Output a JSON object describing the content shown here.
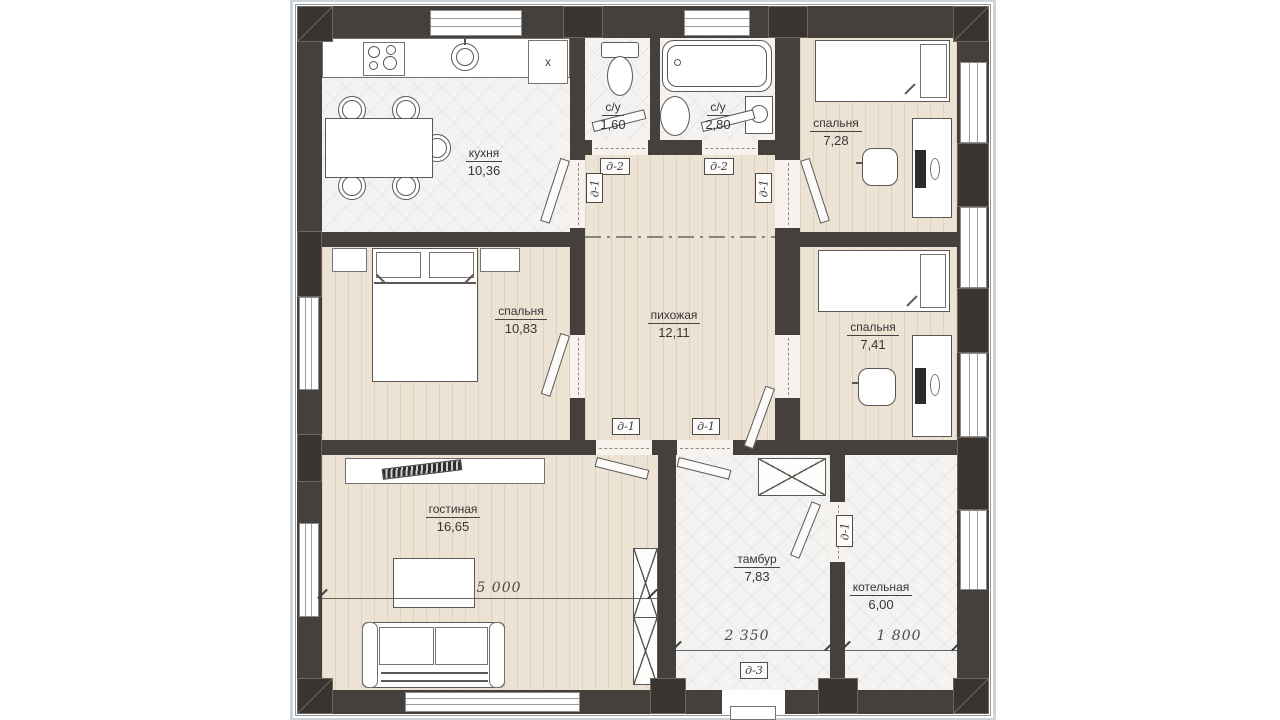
{
  "plan": {
    "rooms": [
      {
        "name": "кухня",
        "area": "10,36"
      },
      {
        "name": "с/у",
        "area": "1,60"
      },
      {
        "name": "с/у",
        "area": "2,80"
      },
      {
        "name": "спальня",
        "area": "7,28"
      },
      {
        "name": "спальня",
        "area": "10,83"
      },
      {
        "name": "пихожая",
        "area": "12,11"
      },
      {
        "name": "спальня",
        "area": "7,41"
      },
      {
        "name": "гостиная",
        "area": "16,65"
      },
      {
        "name": "тамбур",
        "area": "7,83"
      },
      {
        "name": "котельная",
        "area": "6,00"
      }
    ],
    "door_tags": {
      "d1": "д-1",
      "d2": "д-2",
      "d3": "д-3"
    },
    "dimensions": {
      "living": "5 000",
      "vestibule": "2 350",
      "boiler": "1 800"
    },
    "appliance_labels": {
      "fridge": "х"
    },
    "colors": {
      "wall": "#46403c",
      "wood_floor": "#ece3d5",
      "tile_floor": "#f4f3f1",
      "trim": "#ccd4da"
    }
  }
}
